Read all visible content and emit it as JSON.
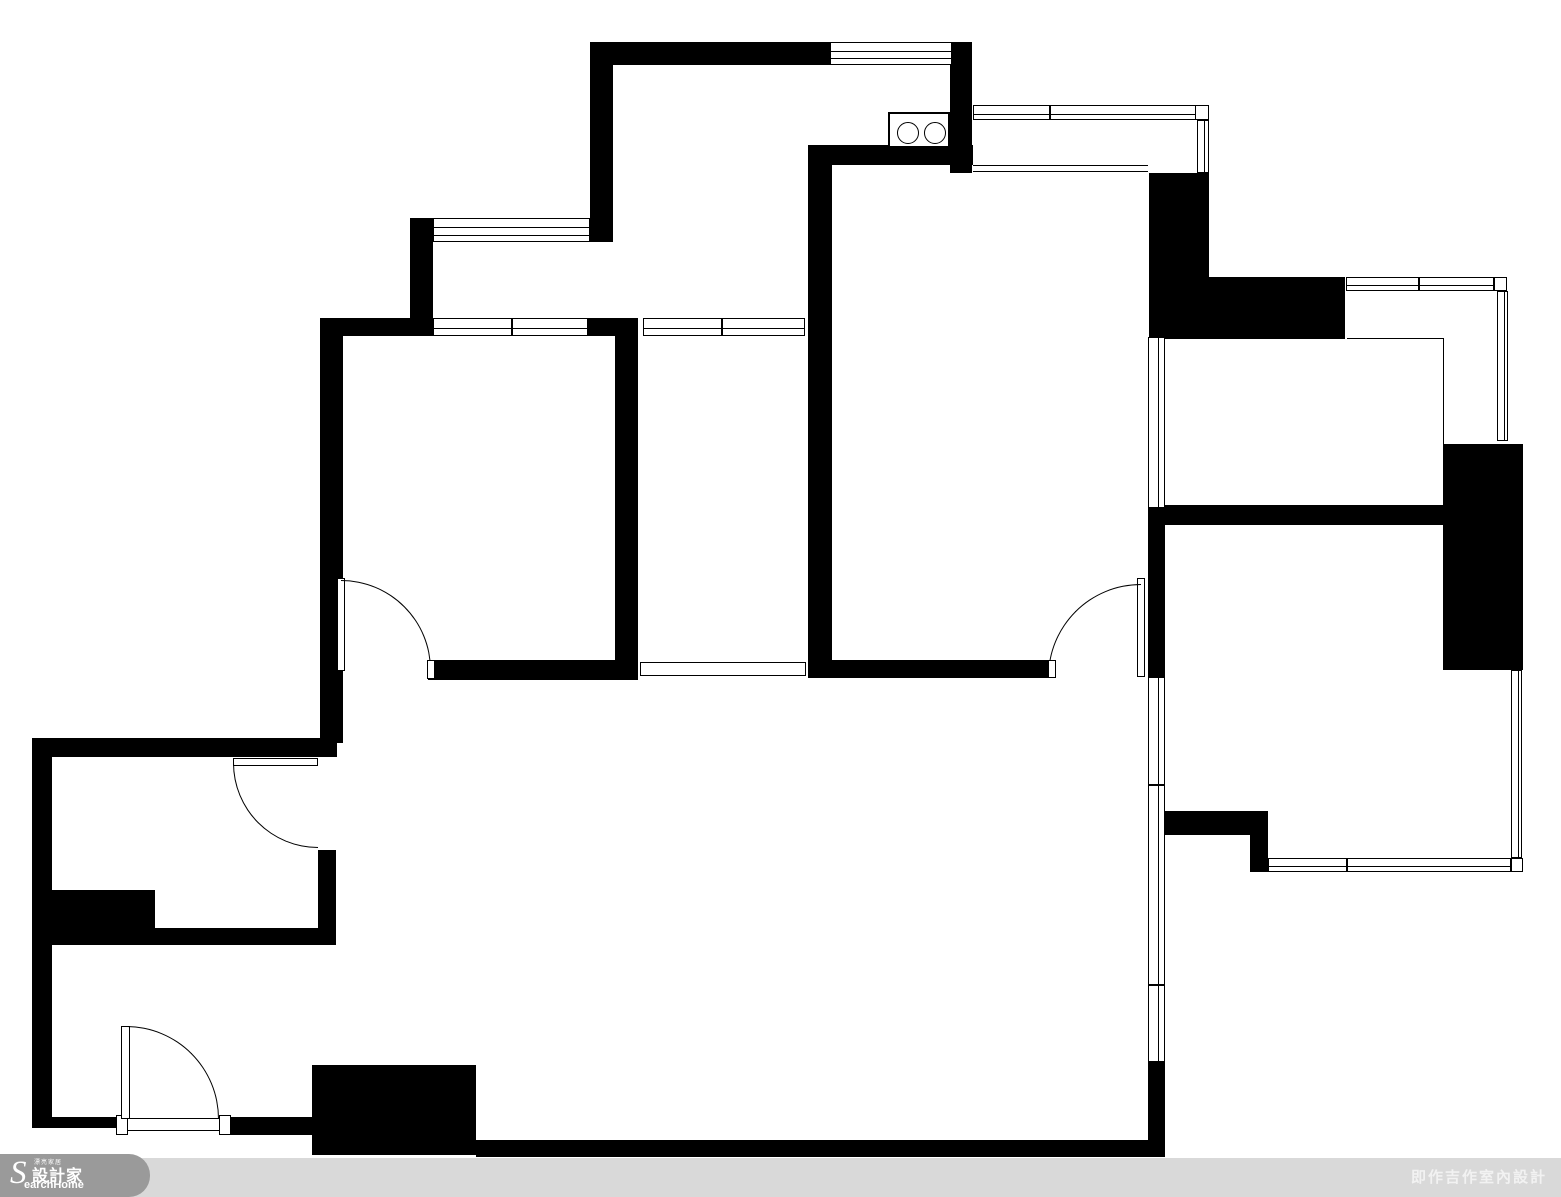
{
  "footer": {
    "credit": "即作吉作室內設計",
    "brand": {
      "s": "S",
      "small_top": "漂亮家居",
      "cjk": "設計家",
      "latin": "earchHome"
    },
    "bar_color": "#d9d9d9",
    "blob_color": "#9a9a9a",
    "credit_color": "#f2f2f2"
  },
  "floorplan": {
    "wall_color": "#000000",
    "background_color": "#ffffff",
    "walls": [
      {
        "x": 590,
        "y": 42,
        "w": 240,
        "h": 23
      },
      {
        "x": 590,
        "y": 42,
        "w": 23,
        "h": 200
      },
      {
        "x": 950,
        "y": 42,
        "w": 22,
        "h": 131
      },
      {
        "x": 808,
        "y": 145,
        "w": 165,
        "h": 20
      },
      {
        "x": 808,
        "y": 145,
        "w": 24,
        "h": 533
      },
      {
        "x": 410,
        "y": 218,
        "w": 23,
        "h": 100
      },
      {
        "x": 320,
        "y": 318,
        "w": 113,
        "h": 18
      },
      {
        "x": 320,
        "y": 318,
        "w": 23,
        "h": 425
      },
      {
        "x": 588,
        "y": 318,
        "w": 50,
        "h": 18
      },
      {
        "x": 615,
        "y": 336,
        "w": 23,
        "h": 344
      },
      {
        "x": 428,
        "y": 660,
        "w": 210,
        "h": 20
      },
      {
        "x": 830,
        "y": 660,
        "w": 220,
        "h": 18
      },
      {
        "x": 1148,
        "y": 505,
        "w": 297,
        "h": 20
      },
      {
        "x": 1148,
        "y": 520,
        "w": 17,
        "h": 157
      },
      {
        "x": 1443,
        "y": 444,
        "w": 80,
        "h": 226
      },
      {
        "x": 1149,
        "y": 173,
        "w": 60,
        "h": 106
      },
      {
        "x": 1149,
        "y": 277,
        "w": 196,
        "h": 62
      },
      {
        "x": 1148,
        "y": 811,
        "w": 120,
        "h": 24
      },
      {
        "x": 1250,
        "y": 835,
        "w": 18,
        "h": 37
      },
      {
        "x": 32,
        "y": 738,
        "w": 305,
        "h": 19
      },
      {
        "x": 32,
        "y": 738,
        "w": 20,
        "h": 390
      },
      {
        "x": 52,
        "y": 890,
        "w": 103,
        "h": 40
      },
      {
        "x": 52,
        "y": 928,
        "w": 284,
        "h": 17
      },
      {
        "x": 318,
        "y": 850,
        "w": 18,
        "h": 95
      },
      {
        "x": 32,
        "y": 1117,
        "w": 88,
        "h": 11
      },
      {
        "x": 228,
        "y": 1117,
        "w": 84,
        "h": 18
      },
      {
        "x": 312,
        "y": 1065,
        "w": 164,
        "h": 90
      },
      {
        "x": 476,
        "y": 1140,
        "w": 689,
        "h": 17
      },
      {
        "x": 1148,
        "y": 1062,
        "w": 17,
        "h": 95
      }
    ],
    "windows": [
      {
        "x": 830,
        "y": 42,
        "w": 122,
        "h": 23,
        "o": "h",
        "lines": 2,
        "mullions": []
      },
      {
        "x": 973,
        "y": 105,
        "w": 224,
        "h": 15,
        "o": "h",
        "lines": 1,
        "mullions": [
          75
        ]
      },
      {
        "x": 1195,
        "y": 105,
        "w": 14,
        "h": 15,
        "o": "h",
        "lines": 0,
        "mullions": []
      },
      {
        "x": 1197,
        "y": 120,
        "w": 12,
        "h": 53,
        "o": "v",
        "lines": 1,
        "mullions": []
      },
      {
        "x": 433,
        "y": 218,
        "w": 157,
        "h": 24,
        "o": "h",
        "lines": 2,
        "mullions": []
      },
      {
        "x": 433,
        "y": 318,
        "w": 155,
        "h": 18,
        "o": "h",
        "lines": 1,
        "mullions": [
          77
        ]
      },
      {
        "x": 643,
        "y": 318,
        "w": 162,
        "h": 18,
        "o": "h",
        "lines": 1,
        "mullions": [
          77
        ]
      },
      {
        "x": 1148,
        "y": 337,
        "w": 17,
        "h": 171,
        "o": "v",
        "lines": 1,
        "mullions": []
      },
      {
        "x": 1346,
        "y": 277,
        "w": 148,
        "h": 14,
        "o": "h",
        "lines": 1,
        "mullions": [
          71
        ]
      },
      {
        "x": 1494,
        "y": 277,
        "w": 13,
        "h": 14,
        "o": "h",
        "lines": 0,
        "mullions": []
      },
      {
        "x": 1497,
        "y": 291,
        "w": 11,
        "h": 150,
        "o": "v",
        "lines": 1,
        "mullions": []
      },
      {
        "x": 1511,
        "y": 670,
        "w": 11,
        "h": 188,
        "o": "v",
        "lines": 1,
        "mullions": []
      },
      {
        "x": 1268,
        "y": 858,
        "w": 243,
        "h": 14,
        "o": "h",
        "lines": 1,
        "mullions": [
          77
        ]
      },
      {
        "x": 1511,
        "y": 858,
        "w": 12,
        "h": 14,
        "o": "h",
        "lines": 0,
        "mullions": []
      },
      {
        "x": 1148,
        "y": 677,
        "w": 17,
        "h": 385,
        "o": "v",
        "lines": 1,
        "mullions": [
          106,
          306
        ]
      },
      {
        "x": 640,
        "y": 662,
        "w": 166,
        "h": 14,
        "o": "h",
        "lines": 0,
        "mullions": []
      },
      {
        "x": 118,
        "y": 1118,
        "w": 113,
        "h": 13,
        "o": "h",
        "lines": 0,
        "mullions": []
      },
      {
        "x": 116,
        "y": 1115,
        "w": 12,
        "h": 20,
        "o": "h",
        "lines": 0,
        "mullions": []
      },
      {
        "x": 219,
        "y": 1115,
        "w": 12,
        "h": 20,
        "o": "h",
        "lines": 0,
        "mullions": []
      }
    ],
    "thin_lines": [
      {
        "x": 973,
        "y": 165,
        "w": 175,
        "h": 1
      },
      {
        "x": 973,
        "y": 171,
        "w": 175,
        "h": 1
      },
      {
        "x": 1347,
        "y": 338,
        "w": 97,
        "h": 1
      },
      {
        "x": 1443,
        "y": 338,
        "w": 1,
        "h": 106
      }
    ],
    "doors": [
      {
        "name": "bedroom1-door",
        "leaf": {
          "x": 337,
          "y": 578,
          "w": 8,
          "h": 93
        },
        "arc": {
          "x": 341,
          "y": 580,
          "r": 90,
          "corner": "tr"
        }
      },
      {
        "name": "dining-door",
        "leaf": {
          "x": 1137,
          "y": 578,
          "w": 8,
          "h": 99
        },
        "arc": {
          "x": 1048,
          "y": 584,
          "r": 93,
          "corner": "tl"
        }
      },
      {
        "name": "bathroom-door",
        "leaf": {
          "x": 233,
          "y": 758,
          "w": 85,
          "h": 8
        },
        "arc": {
          "x": 233,
          "y": 763,
          "r": 85,
          "corner": "bl"
        }
      },
      {
        "name": "entry-door",
        "leaf": {
          "x": 121,
          "y": 1026,
          "w": 9,
          "h": 93
        },
        "arc": {
          "x": 126,
          "y": 1026,
          "r": 93,
          "corner": "tr"
        }
      }
    ],
    "caps": [
      {
        "x": 427,
        "y": 660,
        "w": 8,
        "h": 19
      },
      {
        "x": 1048,
        "y": 660,
        "w": 8,
        "h": 18
      }
    ],
    "stove": {
      "x": 888,
      "y": 112,
      "w": 62,
      "h": 36,
      "burners": [
        {
          "cx": 17,
          "cy": 18,
          "r": 10
        },
        {
          "cx": 44,
          "cy": 18,
          "r": 10
        }
      ]
    }
  }
}
